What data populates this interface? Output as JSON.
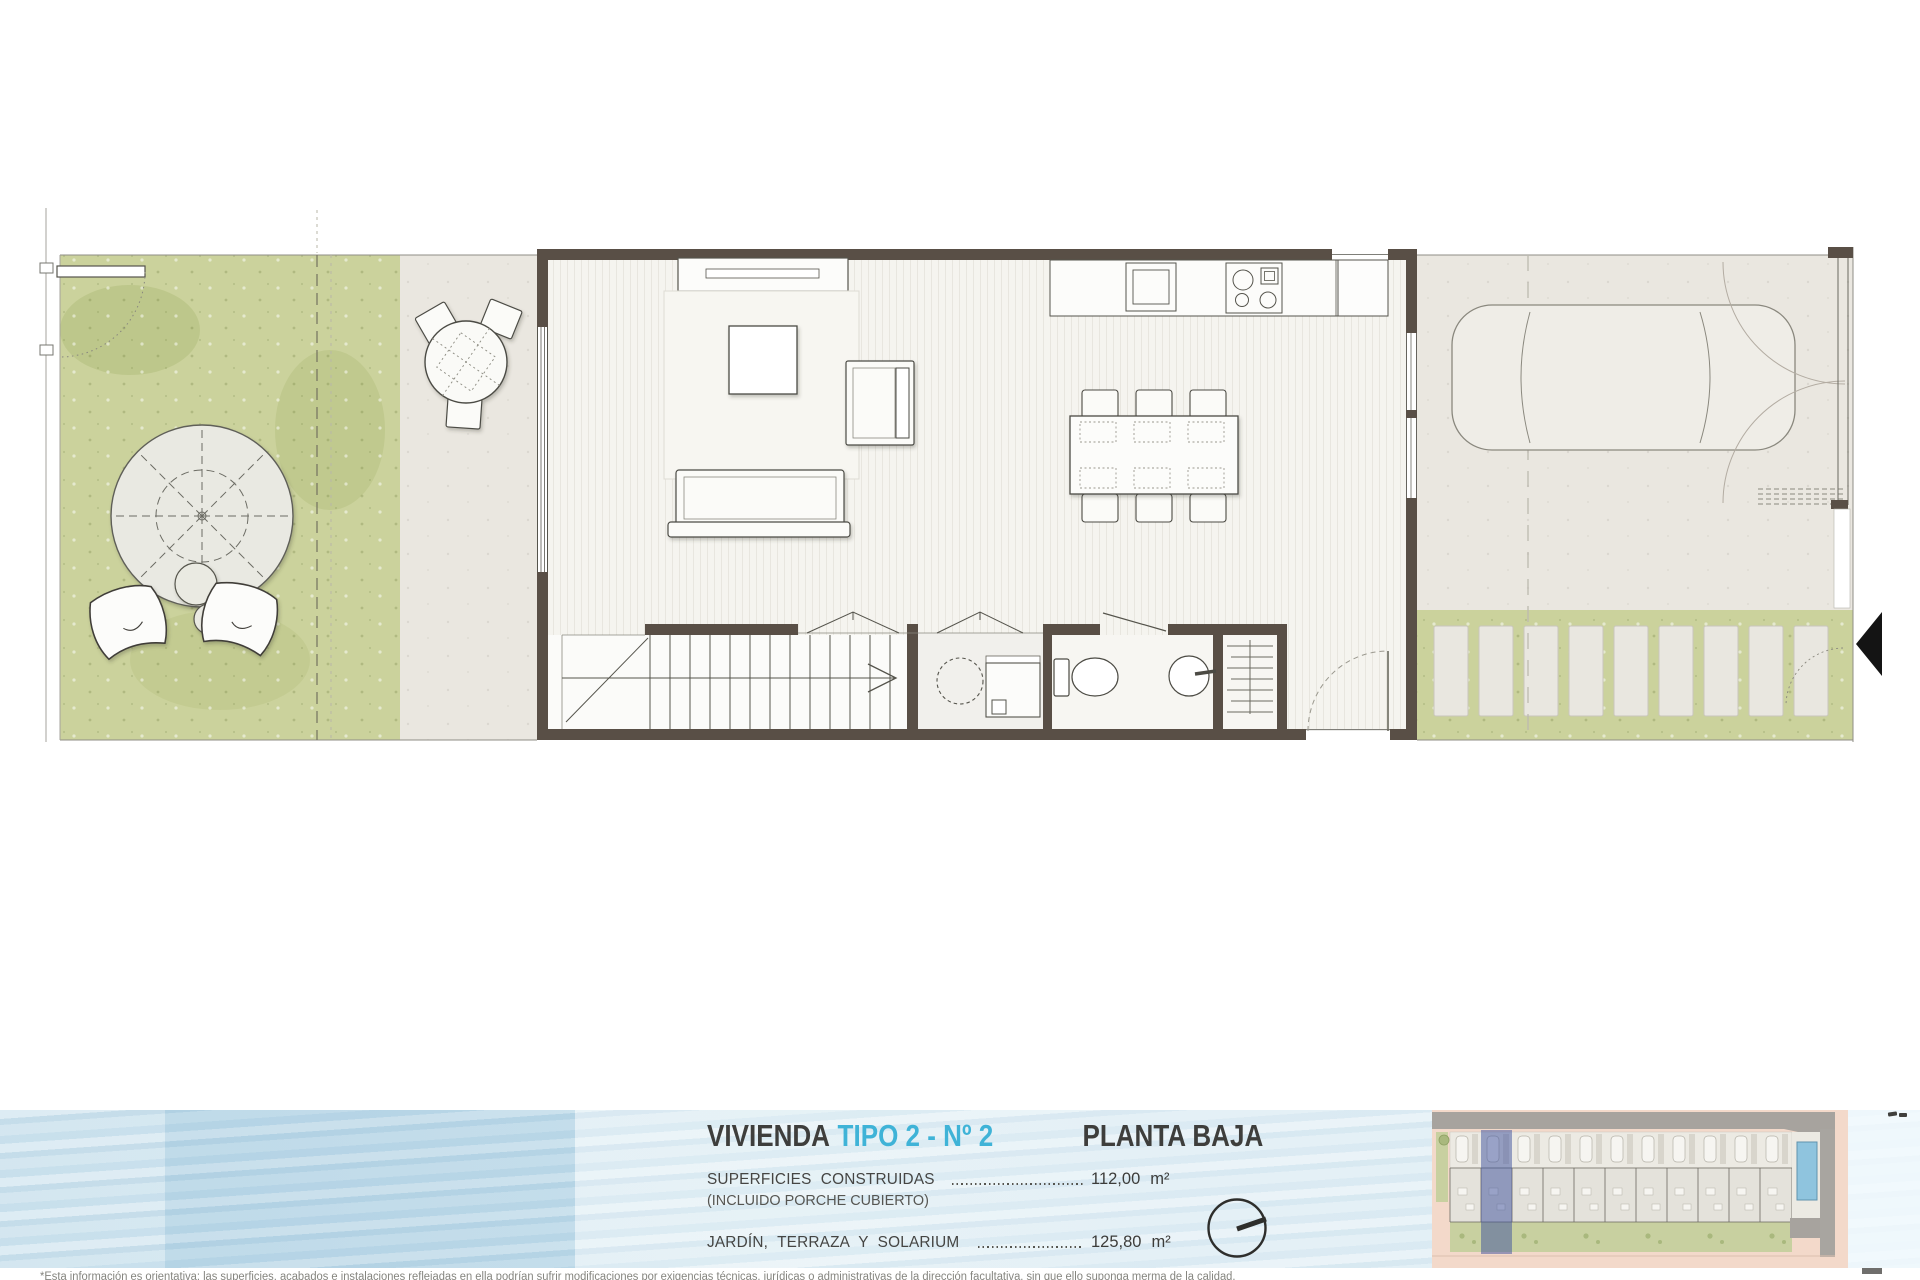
{
  "footer": {
    "title_prefix": "VIVIENDA",
    "title_accent": "TIPO 2 - Nº 2",
    "plan_label": "PLANTA BAJA",
    "rows": [
      {
        "label": "SUPERFICIES CONSTRUIDAS",
        "note": "(INCLUIDO PORCHE CUBIERTO)",
        "value": "112,00",
        "unit": "m²"
      },
      {
        "label": "JARDÍN, TERRAZA Y SOLARIUM",
        "note": "",
        "value": "125,80",
        "unit": "m²"
      }
    ],
    "accent_color": "#3fb3d7",
    "text_color": "#3e3e3c",
    "band_color": "#cde3ee"
  },
  "disclaimer_partial": "*Esta información es orientativa: las superficies, acabados e instalaciones reflejadas en ella podrían sufrir modificaciones por exigencias técnicas, jurídicas o administrativas de la dirección facultativa, sin que ello suponga merma de la calidad.",
  "floor_plan": {
    "colors": {
      "grass": "#cbd29c",
      "paving": "#eae7e0",
      "wall": "#594f46",
      "wood_floor": "#f5f4ef",
      "furniture_outline": "#4c4b44",
      "entrance_arrow": "#141414"
    }
  },
  "site_plan": {
    "highlighted_unit": "Nº 2",
    "colors": {
      "street": "#f3d9ca",
      "road": "#a7a39e",
      "highlight": "rgba(60,80,158,0.5)",
      "pool": "#8fc4de",
      "garden": "#c8d0a0"
    }
  }
}
